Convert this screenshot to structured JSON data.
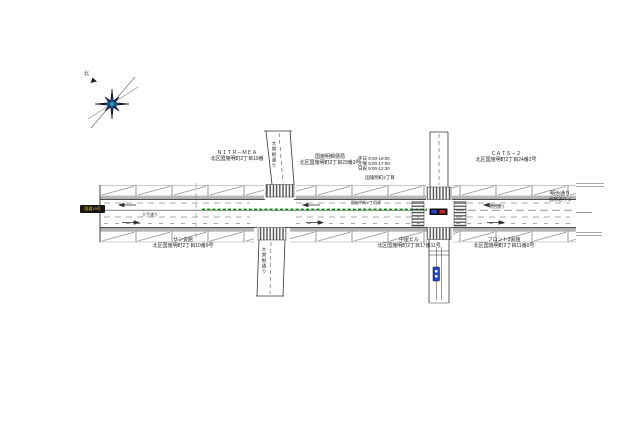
{
  "page": {
    "background": "#ffffff"
  },
  "compass": {
    "label": "北"
  },
  "colors": {
    "line": "#333333",
    "median_green": "#0b7d0b",
    "sidewalk_gray": "#b3b3b3",
    "compass_navy": "#16246e",
    "compass_teal": "#1fa0b4",
    "badge_black": "#161616",
    "badge_yellow": "#e8c520",
    "signal_blue": "#2244cc",
    "signal_red": "#cc2222"
  },
  "labels": {
    "building_nw": {
      "name": "ＮＩＴＲ－ＭＥＡ",
      "address": "北区国施明町2丁目19番"
    },
    "post_office": {
      "name": "国施明郵便局",
      "address": "北区国施明町2丁目23番3号",
      "hours": [
        "平日 9:00-19:00",
        "土曜 9:00-17:00",
        "日祝 9:00-12:30"
      ],
      "area_label": "国施明町2丁目"
    },
    "building_ne": {
      "name": "ＣＡＴＳ－２",
      "address": "北区国施明町2丁目24番2号"
    },
    "street_right": {
      "name": "明治通り",
      "sub": "仮称通り 2"
    },
    "building_sw": {
      "name": "サン会館",
      "address": "北区国施明町2丁目10番9号"
    },
    "building_s": {
      "name": "中屋ビル",
      "address": "北区国施明町2丁目17番11号"
    },
    "building_se": {
      "name": "フロント3会館",
      "address": "北区国施明町2丁目11番0号"
    },
    "road_vertical_upper": "大曽根通り",
    "road_vertical_lower": "大曽根通り",
    "lane_label_left": "大手通り",
    "lane_label_mid": "国施明町2丁目東",
    "lane_label_right": "明治通り",
    "route_badge": "国道19号"
  }
}
